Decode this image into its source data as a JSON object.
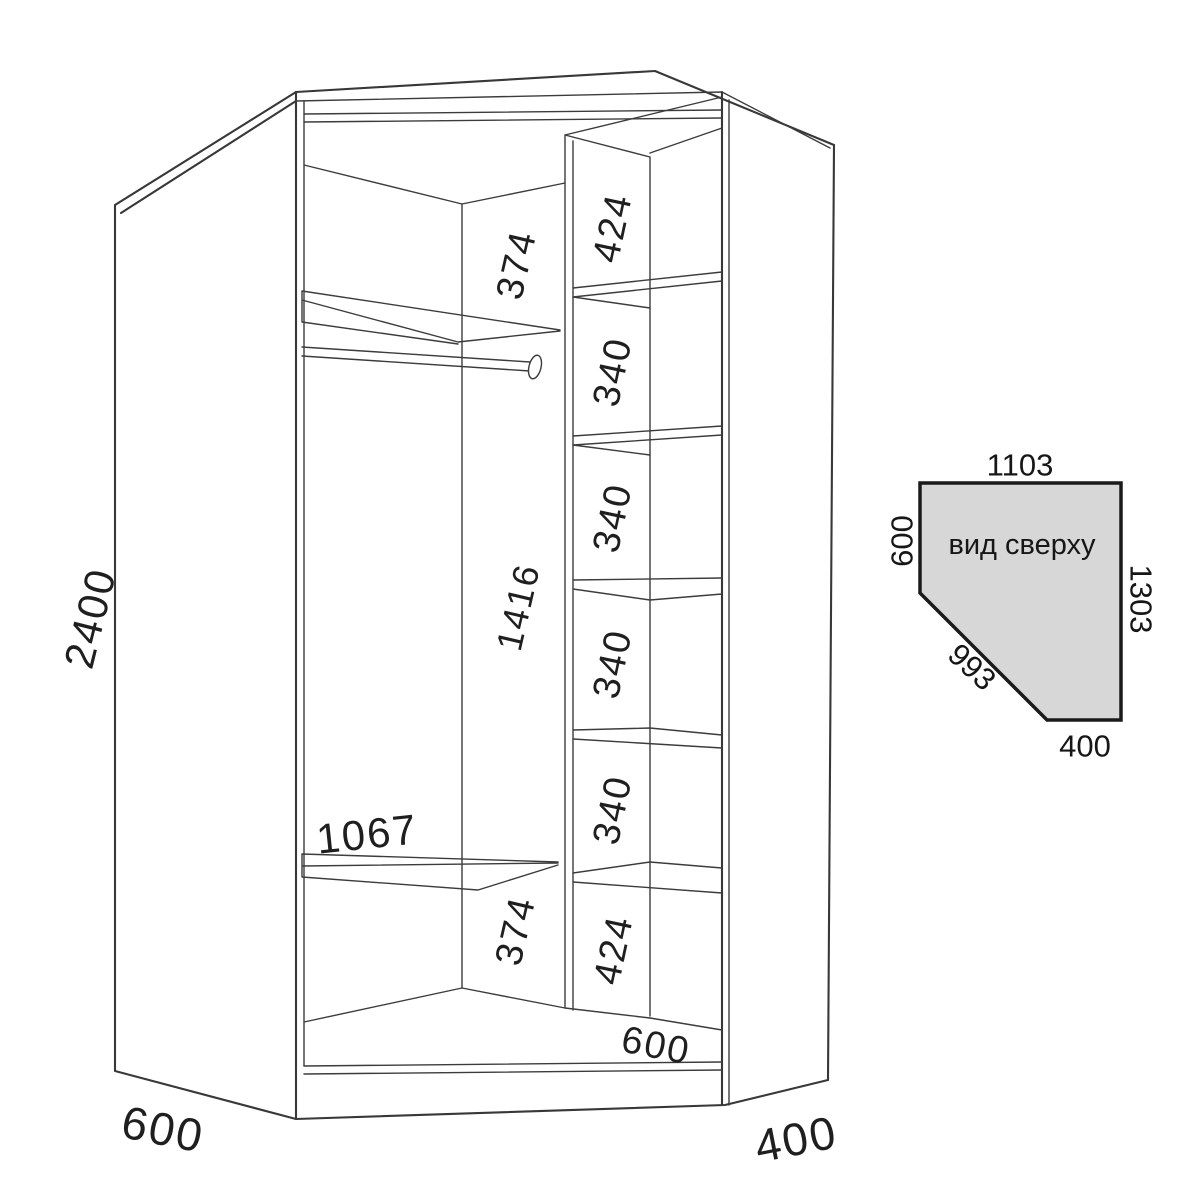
{
  "drawing": {
    "height": "2400",
    "left_depth": "600",
    "right_width": "400",
    "top_gap": "374",
    "mid_height": "1416",
    "bottom_gap": "374",
    "shelf_width": "1067",
    "floor_width": "600",
    "column": [
      "424",
      "340",
      "340",
      "340",
      "340",
      "424"
    ]
  },
  "top_view": {
    "caption": "вид сверху",
    "back": "1103",
    "left": "600",
    "right": "1303",
    "diagonal": "993",
    "front_right": "400",
    "fill": "#d7d7d7"
  }
}
